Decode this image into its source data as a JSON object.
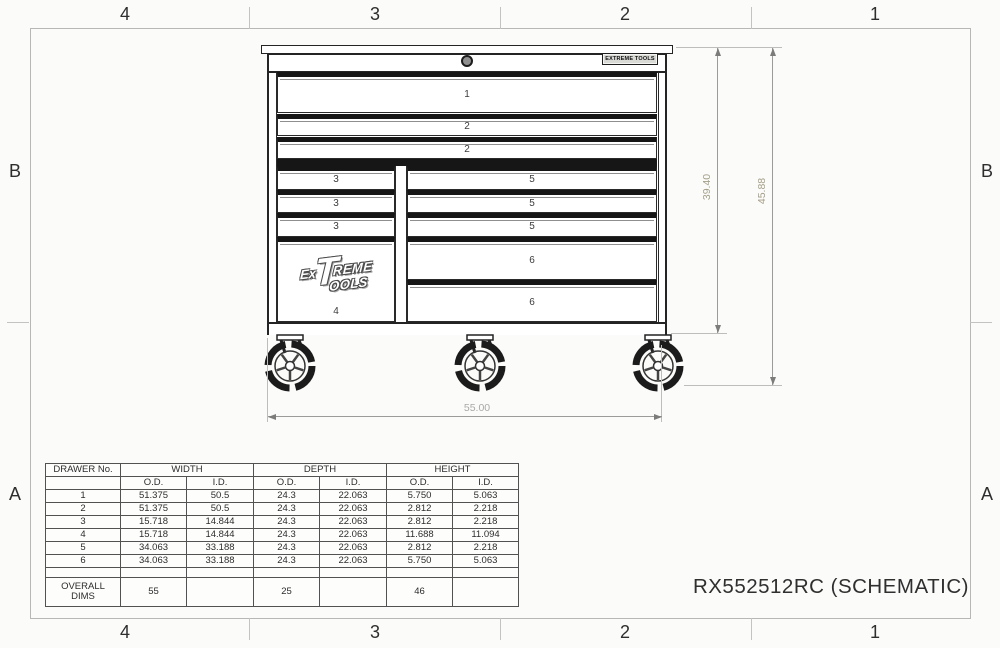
{
  "title": "RX552512RC (SCHEMATIC)",
  "border_zones": {
    "top": [
      "4",
      "3",
      "2",
      "1"
    ],
    "bottom": [
      "4",
      "3",
      "2",
      "1"
    ],
    "left": [
      "B",
      "A"
    ],
    "right": [
      "B",
      "A"
    ]
  },
  "cabinet": {
    "badge_text": "EXTREME TOOLS",
    "logo": {
      "ex": "Ex",
      "big_t": "T",
      "reme": "REME",
      "ools": "OOLS"
    },
    "drawer_numbers": {
      "d1": "1",
      "d2a": "2",
      "d2b": "2",
      "d3a": "3",
      "d3b": "3",
      "d3c": "3",
      "d4": "4",
      "d5a": "5",
      "d5b": "5",
      "d5c": "5",
      "d6a": "6",
      "d6b": "6"
    }
  },
  "dimensions": {
    "width": "55.00",
    "body_height": "39.40",
    "overall_height": "45.88"
  },
  "spec_table": {
    "group_headers": [
      "DRAWER No.",
      "WIDTH",
      "DEPTH",
      "HEIGHT"
    ],
    "sub_headers": [
      "O.D.",
      "I.D.",
      "O.D.",
      "I.D.",
      "O.D.",
      "I.D."
    ],
    "rows": [
      [
        "1",
        "51.375",
        "50.5",
        "24.3",
        "22.063",
        "5.750",
        "5.063"
      ],
      [
        "2",
        "51.375",
        "50.5",
        "24.3",
        "22.063",
        "2.812",
        "2.218"
      ],
      [
        "3",
        "15.718",
        "14.844",
        "24.3",
        "22.063",
        "2.812",
        "2.218"
      ],
      [
        "4",
        "15.718",
        "14.844",
        "24.3",
        "22.063",
        "11.688",
        "11.094"
      ],
      [
        "5",
        "34.063",
        "33.188",
        "24.3",
        "22.063",
        "2.812",
        "2.218"
      ],
      [
        "6",
        "34.063",
        "33.188",
        "24.3",
        "22.063",
        "5.750",
        "5.063"
      ]
    ],
    "overall_row": {
      "label": "OVERALL\nDIMS",
      "width_od": "55",
      "depth_od": "25",
      "height_od": "46"
    }
  },
  "colors": {
    "cabinet_line": "#242424",
    "drawing_border": "#b7b7b5",
    "dimension_line": "#9b9b99",
    "dimension_text_gray": "#a9a9a7",
    "dimension_text_olive": "#a49f87"
  }
}
